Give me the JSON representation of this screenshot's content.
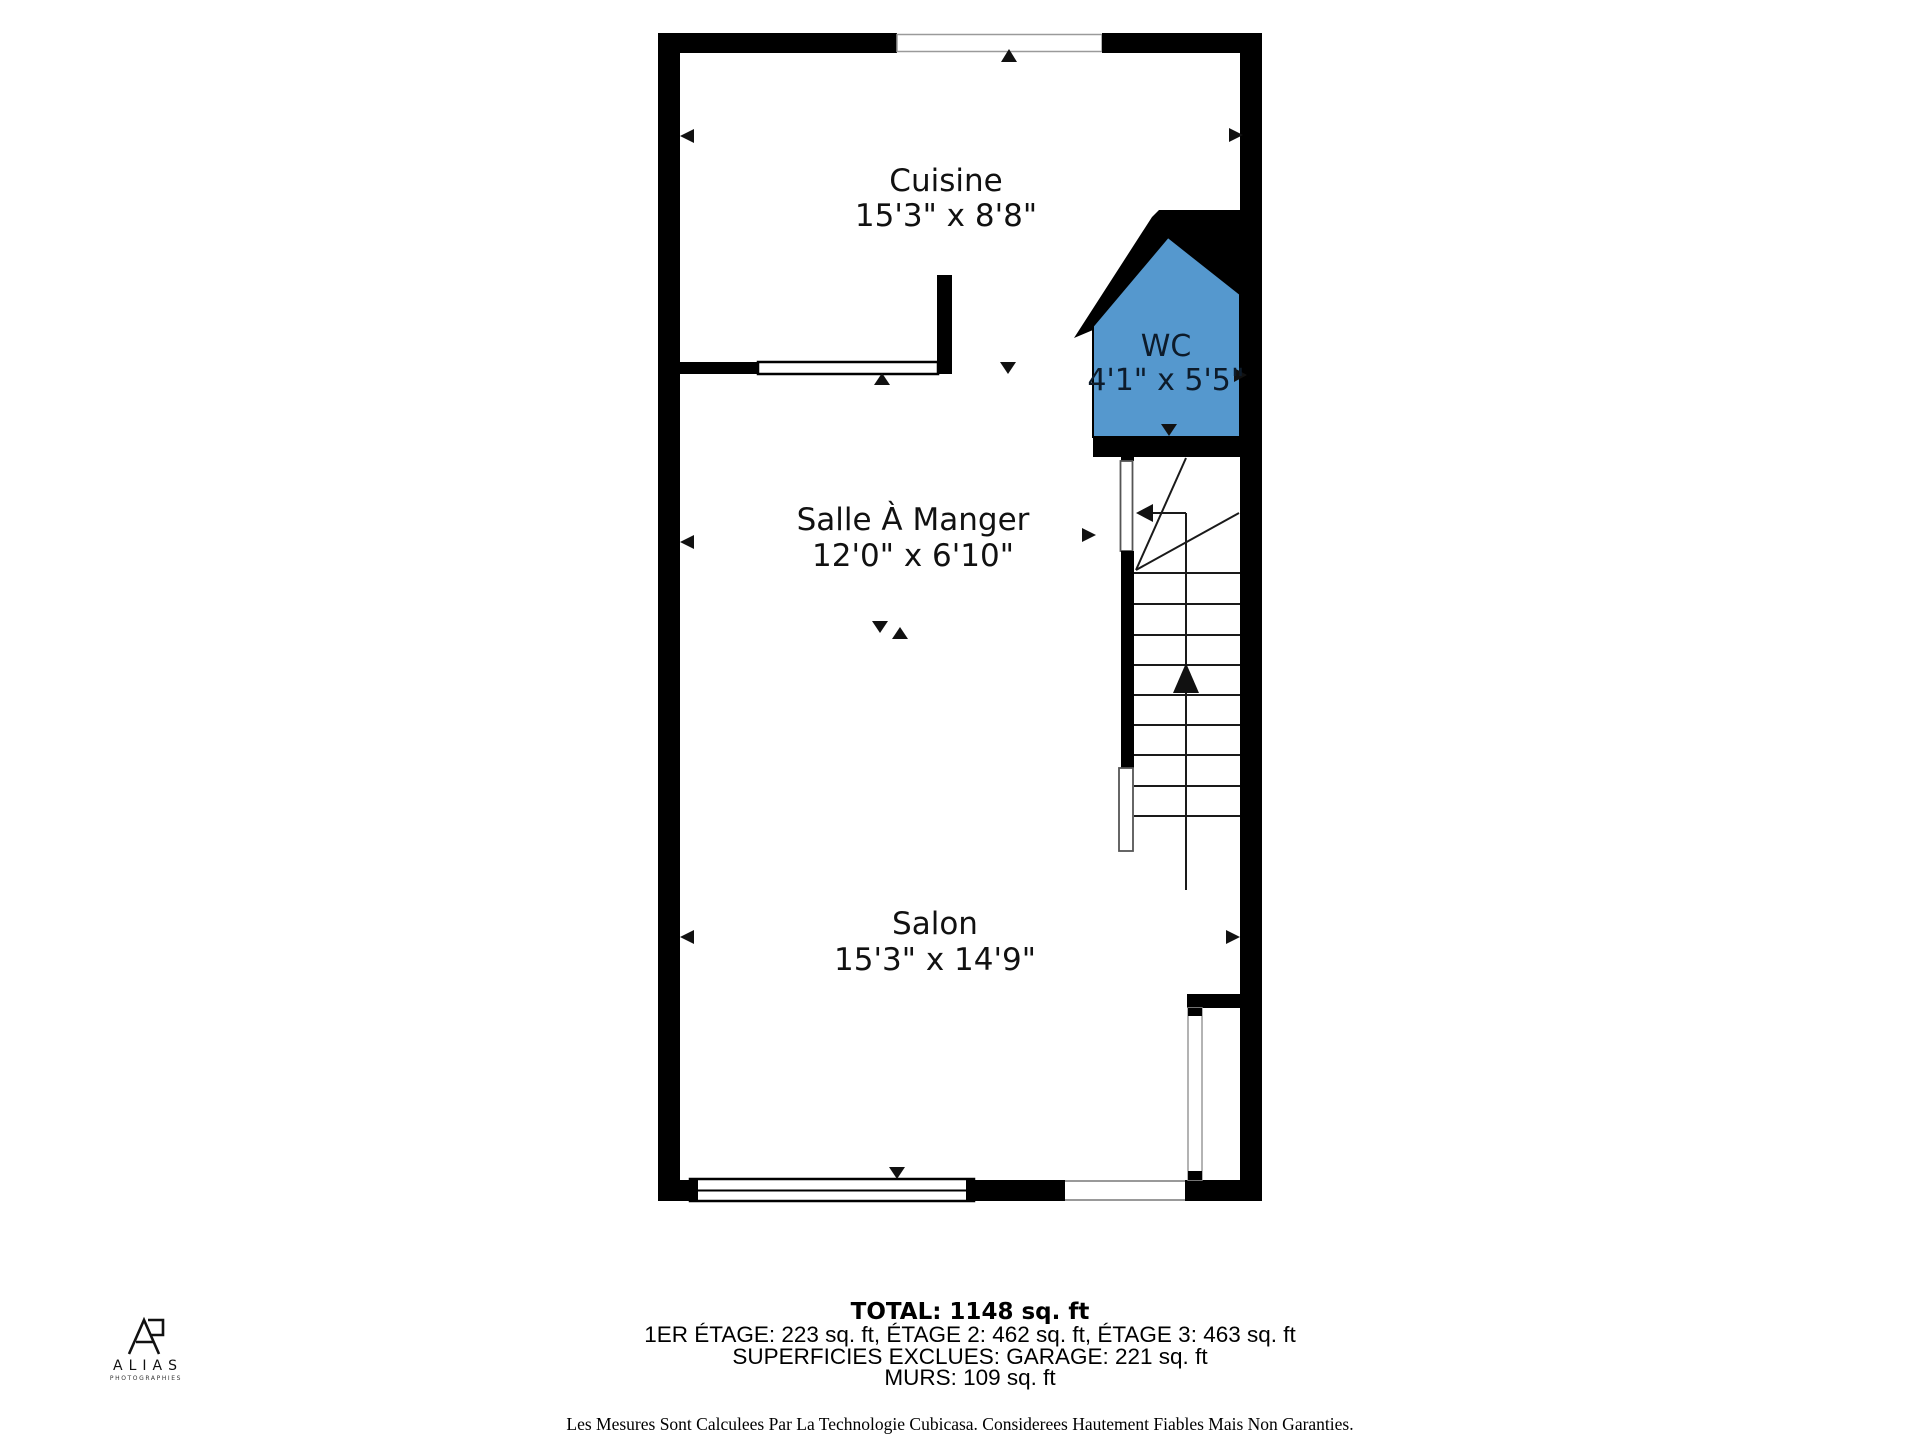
{
  "rooms": {
    "cuisine": {
      "name": "Cuisine",
      "dims": "15'3\" x 8'8\""
    },
    "wc": {
      "name": "WC",
      "dims": "4'1\" x 5'5\""
    },
    "salle_a_manger": {
      "name": "Salle À Manger",
      "dims": "12'0\" x 6'10\""
    },
    "salon": {
      "name": "Salon",
      "dims": "15'3\" x 14'9\""
    }
  },
  "colors": {
    "wc_fill": "#5598CE",
    "wall": "#000000"
  },
  "summary": {
    "total": "TOTAL: 1148 sq. ft",
    "floors": "1ER ÉTAGE: 223 sq. ft, ÉTAGE 2: 462 sq. ft, ÉTAGE 3: 463 sq. ft",
    "excluded": "SUPERFICIES EXCLUES: GARAGE: 221 sq. ft",
    "walls": "MURS: 109 sq. ft"
  },
  "disclaimer": "Les Mesures Sont Calculees Par La Technologie Cubicasa. Considerees Hautement Fiables Mais Non Garanties.",
  "logo": {
    "name": "ALIAS",
    "subtitle": "PHOTOGRAPHIES"
  }
}
